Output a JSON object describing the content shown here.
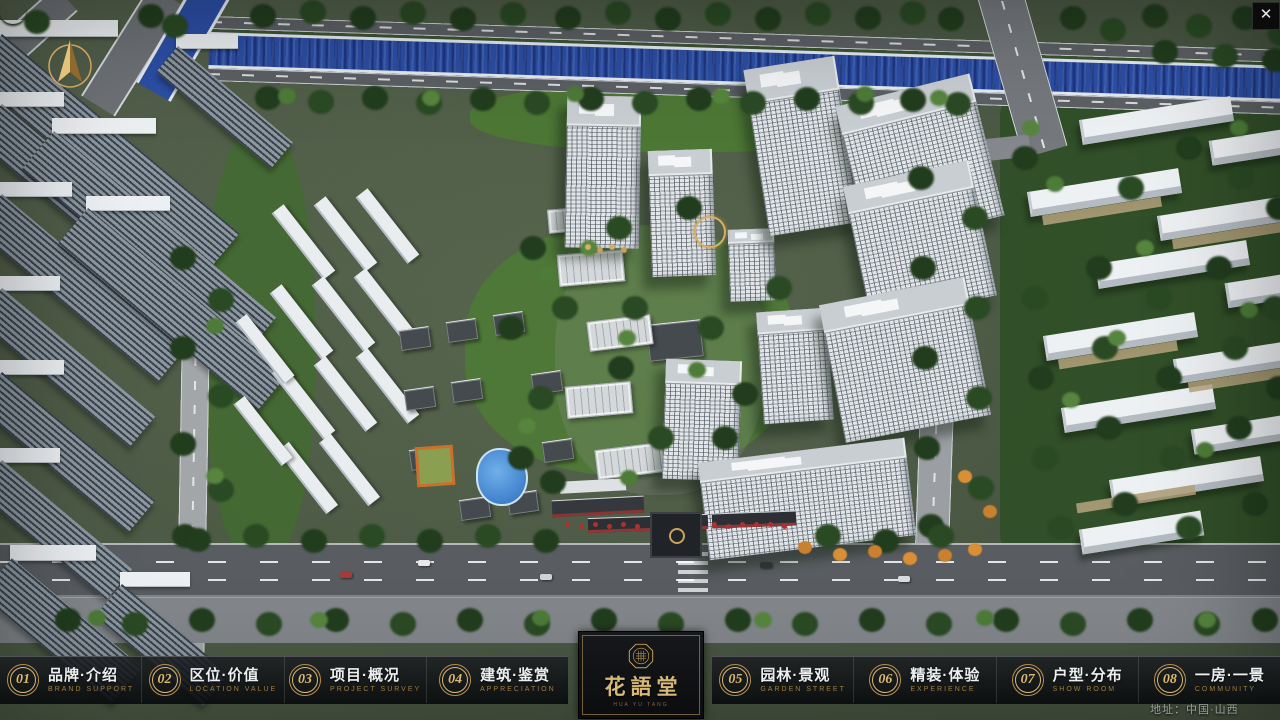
{
  "window": {
    "close_label": "✕"
  },
  "map": {
    "address_label": "地址：中国·山西"
  },
  "logo": {
    "title": "花語堂",
    "subtitle": "HUA YU TANG"
  },
  "nav": {
    "items": [
      {
        "num": "01",
        "label": "品牌·介绍",
        "sub": "BRAND SUPPORT"
      },
      {
        "num": "02",
        "label": "区位·价值",
        "sub": "LOCATION VALUE"
      },
      {
        "num": "03",
        "label": "项目·概况",
        "sub": "PROJECT SURVEY"
      },
      {
        "num": "04",
        "label": "建筑·鉴赏",
        "sub": "APPRECIATION"
      },
      {
        "num": "05",
        "label": "园林·景观",
        "sub": "GARDEN STREET"
      },
      {
        "num": "06",
        "label": "精装·体验",
        "sub": "EXPERIENCE"
      },
      {
        "num": "07",
        "label": "户型·分布",
        "sub": "SHOW ROOM"
      },
      {
        "num": "08",
        "label": "一房·一景",
        "sub": "COMMUNITY"
      }
    ]
  },
  "colors": {
    "gold": "#c9a35c",
    "river": "#2c4fa6",
    "nav_bg": "rgba(10,12,14,0.85)"
  }
}
